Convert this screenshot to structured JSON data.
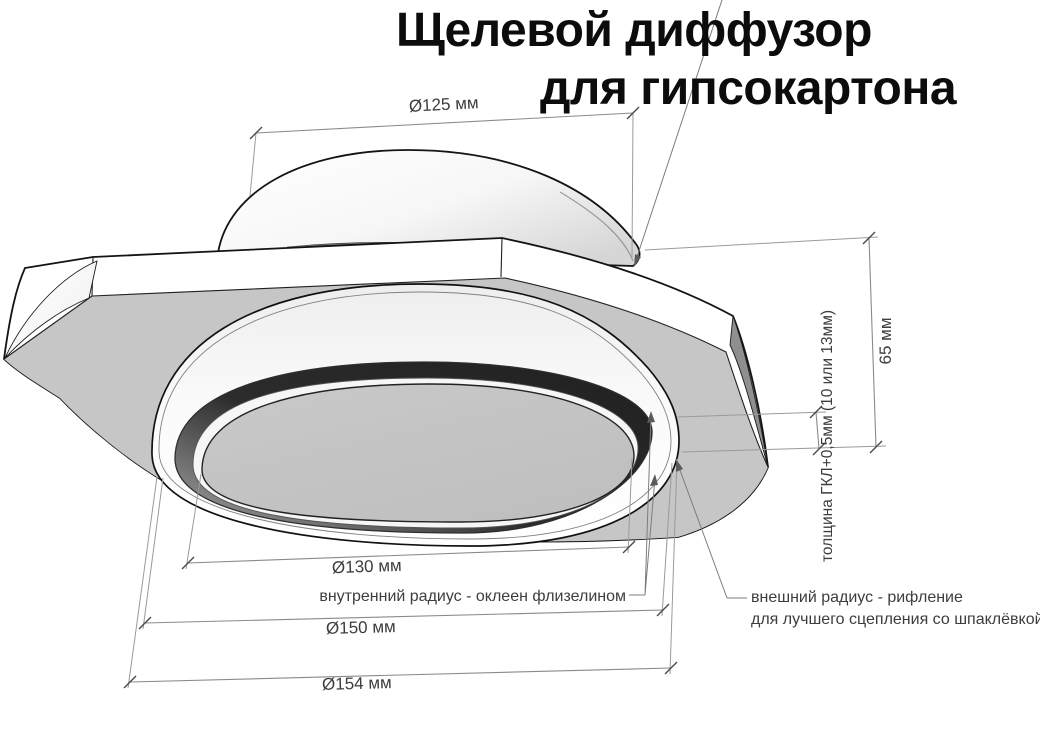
{
  "title": {
    "line1": "Щелевой диффузор",
    "line2": "для гипсокартона"
  },
  "dimensions": {
    "top_diameter": {
      "label": "Ø125 мм"
    },
    "height": {
      "label": "65 мм"
    },
    "board_thickness": {
      "label": "толщина ГКЛ+0,5мм (10 или 13мм)"
    },
    "inner_diameter": {
      "label": "Ø130 мм"
    },
    "middle_diameter": {
      "label": "Ø150 мм"
    },
    "outer_diameter": {
      "label": "Ø154 мм"
    }
  },
  "callouts": {
    "inner_radius": {
      "text": "внутренний радиус - оклеен флизелином"
    },
    "outer_radius": {
      "line1": "внешний радиус - рифление",
      "line2": "для лучшего сцепления со шпаклёвкой"
    }
  },
  "colors": {
    "background": "#ffffff",
    "plate_face": "#c6c6c6",
    "slot_dark": "#262626",
    "corner_facet": "#8f8f8f",
    "dimension_line": "#8a8a8a",
    "dimension_text": "#3d3d3d",
    "title_text": "#0c0c0c"
  }
}
